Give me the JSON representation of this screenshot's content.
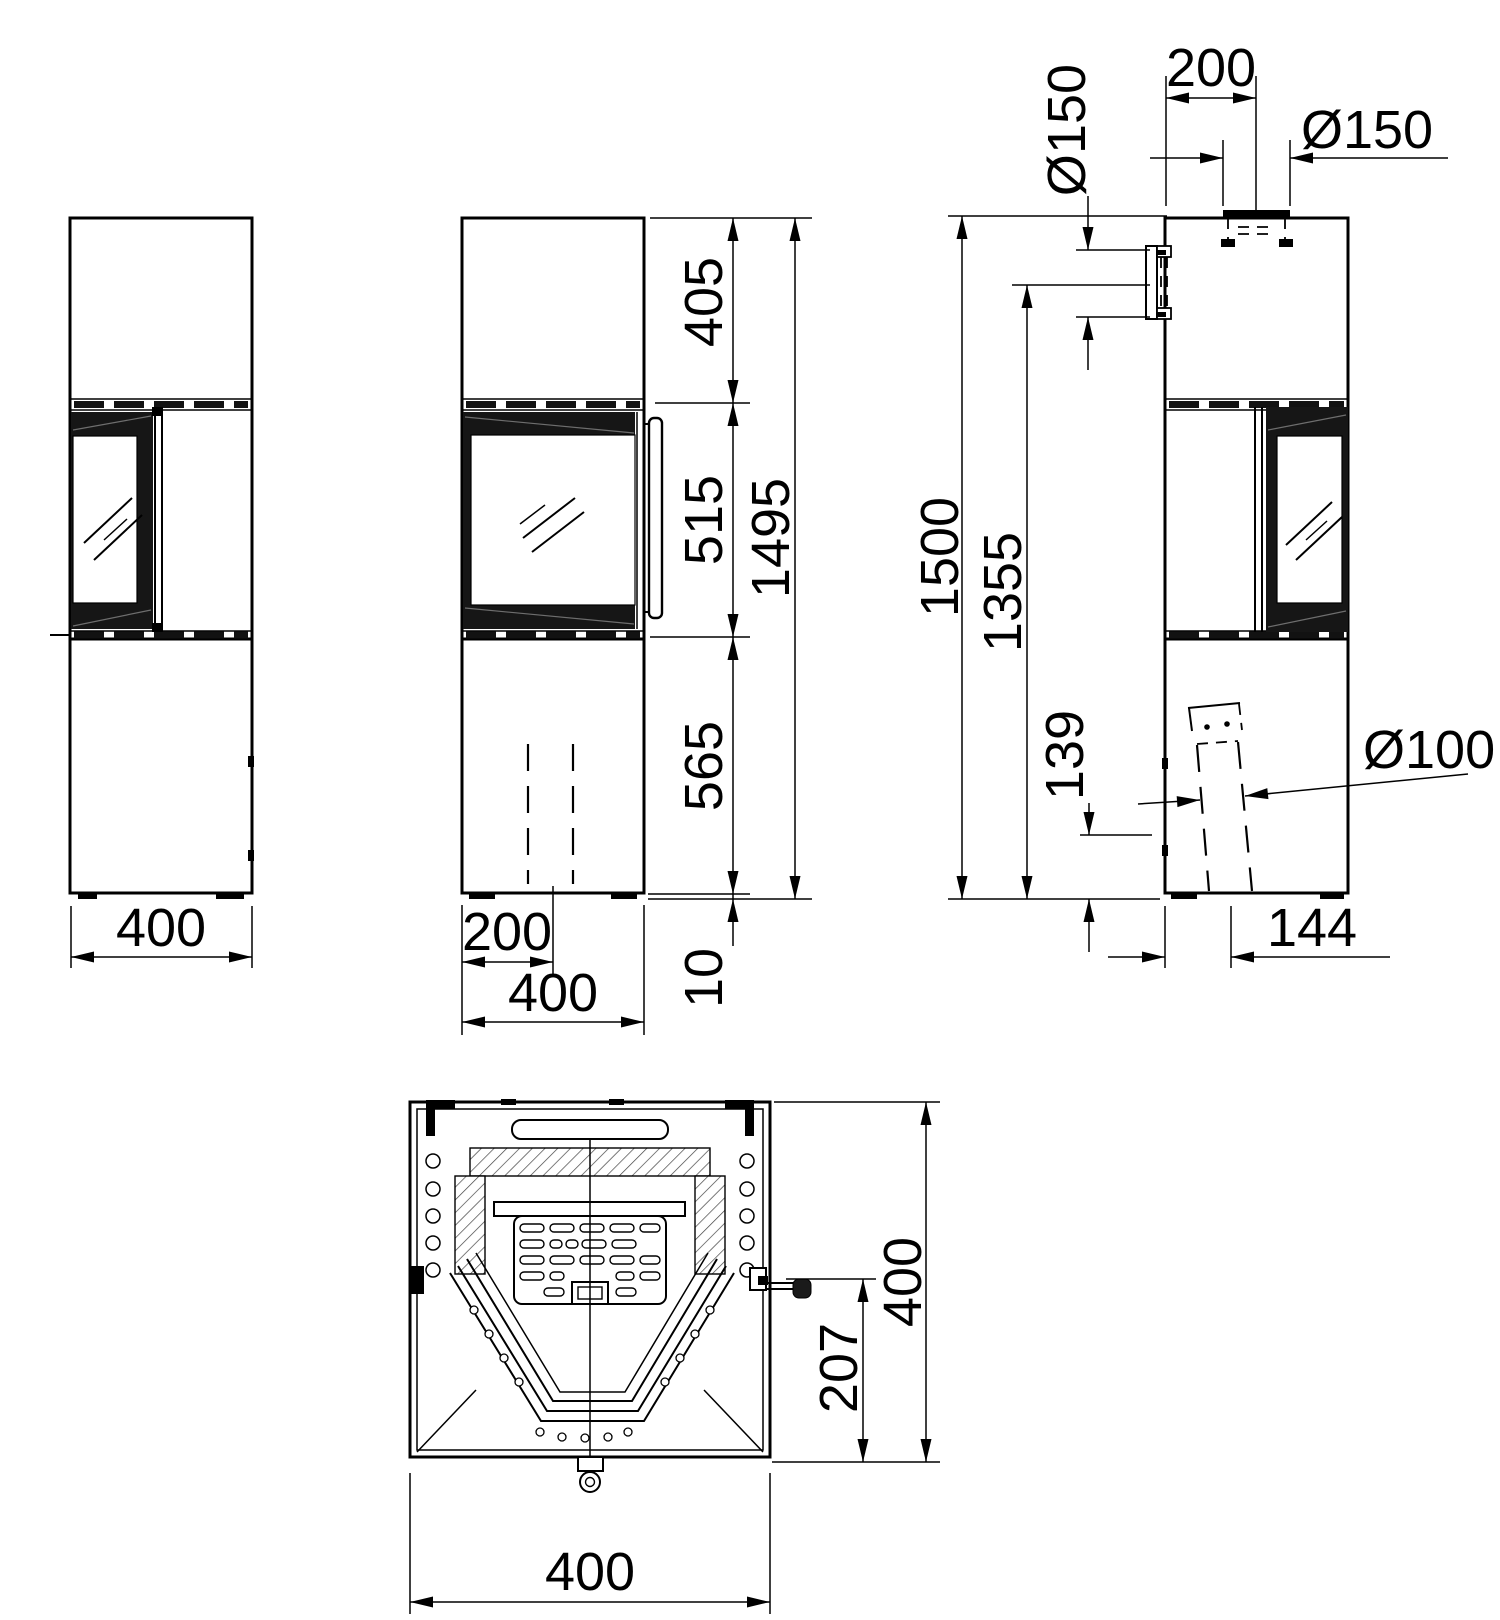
{
  "drawing": {
    "background": "#ffffff",
    "line_color": "#000000",
    "views": {
      "side_left": {
        "dim_width": "400"
      },
      "front": {
        "dim_top_section": "405",
        "dim_glass_section": "515",
        "dim_base_section": "565",
        "dim_feet": "10",
        "dim_total_height": "1495",
        "dim_duct_offset": "200",
        "dim_width": "400"
      },
      "side_right": {
        "dim_flue_offset": "200",
        "dim_top_flue_diameter": "Ø150",
        "dim_rear_flue_diameter": "Ø150",
        "dim_total_height": "1500",
        "dim_rear_flue_height": "1355",
        "dim_intake_height": "139",
        "dim_intake_diameter": "Ø100",
        "dim_intake_offset": "144"
      },
      "plan": {
        "dim_depth": "400",
        "dim_handle_to_front": "207",
        "dim_width": "400"
      }
    }
  }
}
